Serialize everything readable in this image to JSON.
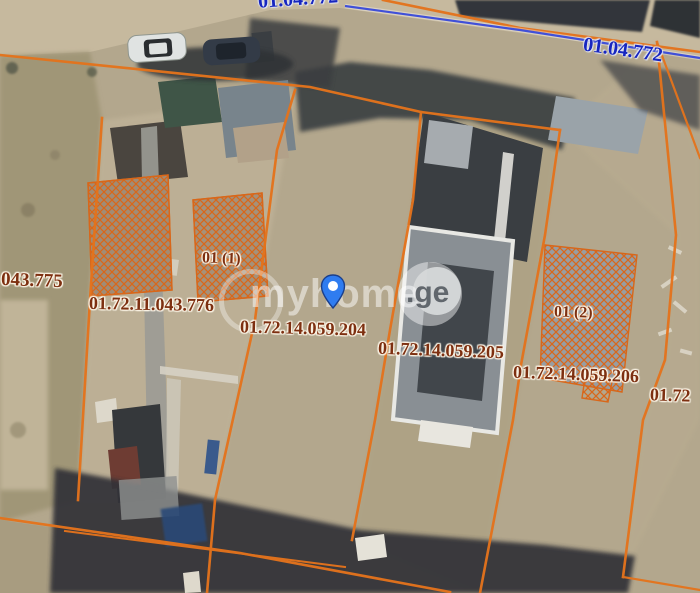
{
  "map": {
    "title": "cadastral satellite map",
    "watermark": {
      "main": "myhome",
      "suffix": ".ge"
    },
    "marker": {
      "label": "location-pin"
    },
    "road_labels": [
      {
        "text": "01.04.772"
      },
      {
        "text": "01.04.772"
      }
    ],
    "parcel_labels": [
      {
        "text": "043.775"
      },
      {
        "text": "01 (1)"
      },
      {
        "text": "01.72.11.043.776"
      },
      {
        "text": "01.72.14.059.204"
      },
      {
        "text": "01.72.14.059.205"
      },
      {
        "text": "01.72.14.059.206"
      },
      {
        "text": "01 (2)"
      },
      {
        "text": "01.72"
      }
    ],
    "colors": {
      "parcel_boundary": "#e4731c",
      "road_line": "#4050d8",
      "parcel_label": "#7d2f10",
      "road_label": "#1726bf",
      "pin": "#2f7cf0"
    }
  }
}
